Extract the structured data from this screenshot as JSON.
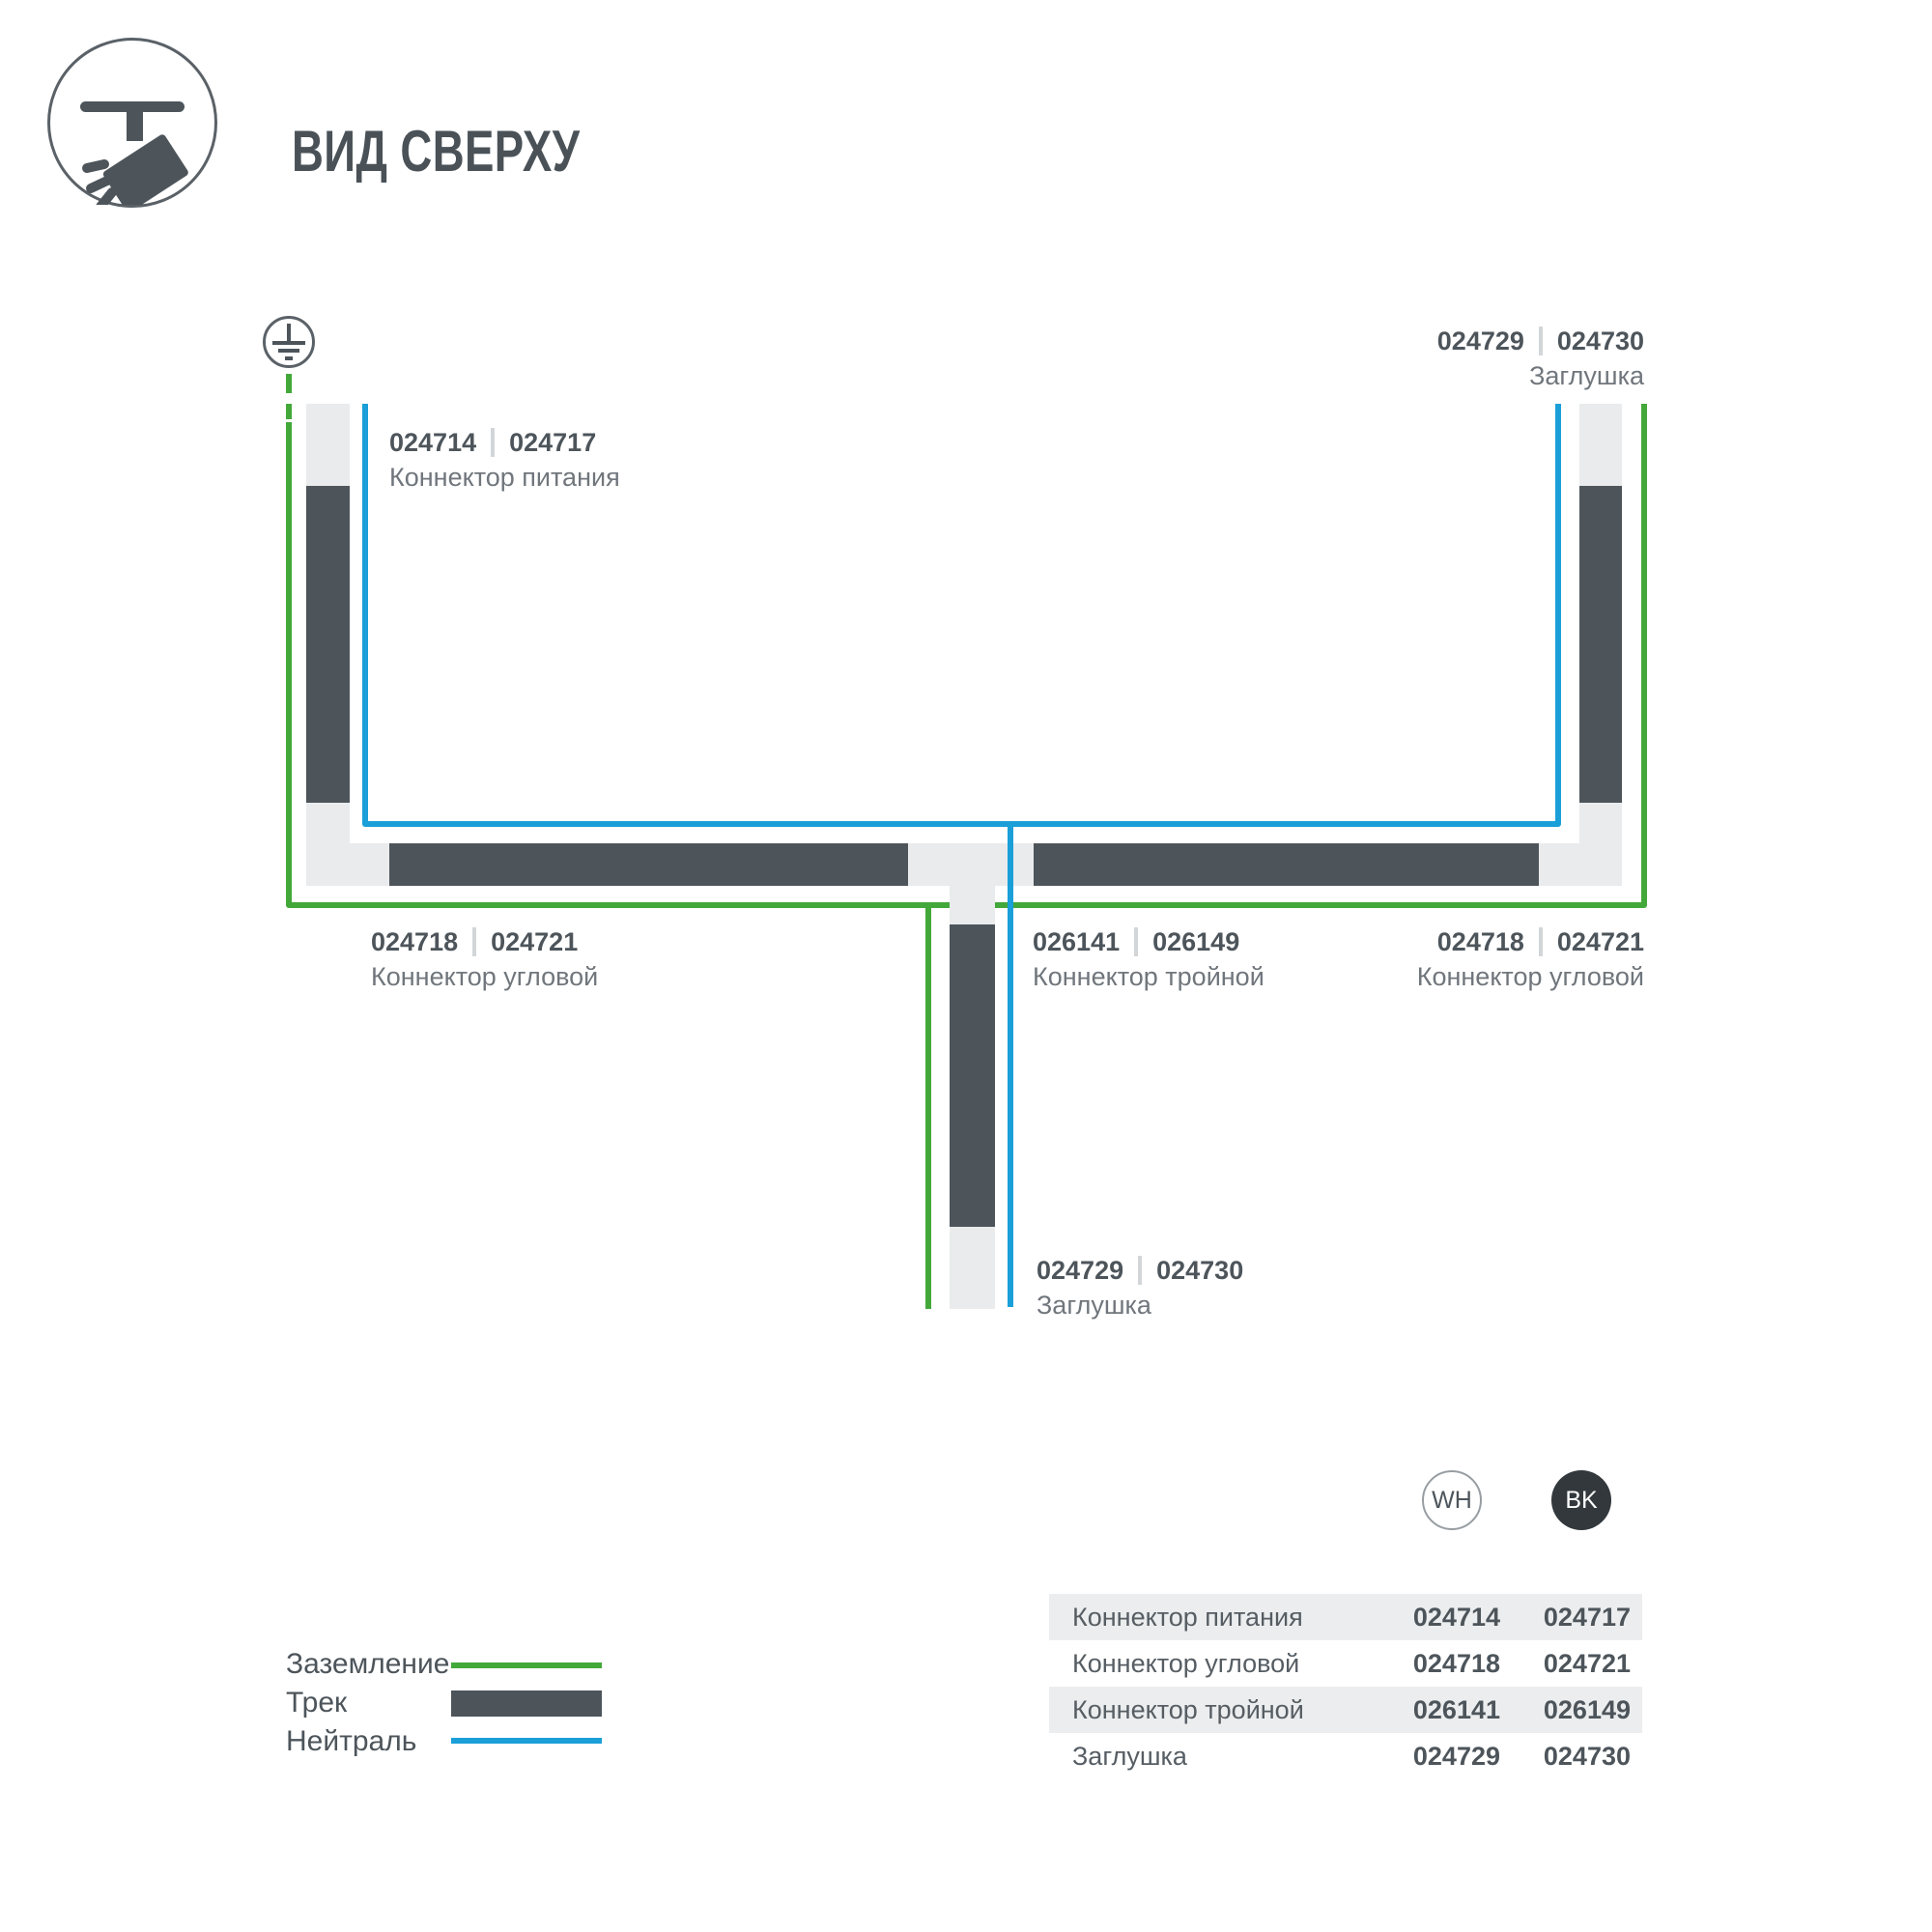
{
  "header": {
    "title": "ВИД СВЕРХУ"
  },
  "colors": {
    "track": "#4d555b",
    "connector": "#e9ebec",
    "ground_line": "#43a83a",
    "neutral_line": "#1b9fd9",
    "text_primary": "#4d555b",
    "text_secondary": "#70767c",
    "row_stripe": "#ebedee",
    "badge_black": "#32383c"
  },
  "diagram": {
    "power_connector": {
      "code_wh": "024714",
      "code_bk": "024717",
      "name": "Коннектор питания"
    },
    "end_cap_top": {
      "code_wh": "024729",
      "code_bk": "024730",
      "name": "Заглушка"
    },
    "corner_left": {
      "code_wh": "024718",
      "code_bk": "024721",
      "name": "Коннектор угловой"
    },
    "triple_connector": {
      "code_wh": "026141",
      "code_bk": "026149",
      "name": "Коннектор тройной"
    },
    "corner_right": {
      "code_wh": "024718",
      "code_bk": "024721",
      "name": "Коннектор угловой"
    },
    "end_cap_bottom": {
      "code_wh": "024729",
      "code_bk": "024730",
      "name": "Заглушка"
    }
  },
  "legend": {
    "ground": "Заземление",
    "track": "Трек",
    "neutral": "Нейтраль"
  },
  "variants": {
    "white": "WH",
    "black": "BK"
  },
  "table": {
    "rows": [
      {
        "name": "Коннектор питания",
        "wh": "024714",
        "bk": "024717"
      },
      {
        "name": "Коннектор угловой",
        "wh": "024718",
        "bk": "024721"
      },
      {
        "name": "Коннектор тройной",
        "wh": "026141",
        "bk": "026149"
      },
      {
        "name": "Заглушка",
        "wh": "024729",
        "bk": "024730"
      }
    ]
  }
}
